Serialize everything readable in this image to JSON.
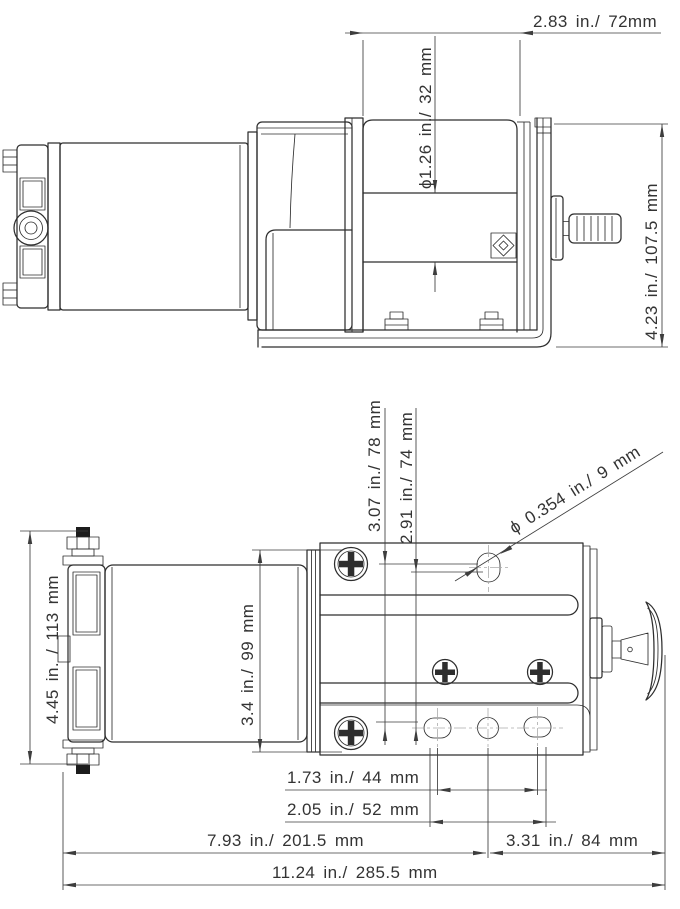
{
  "drawing": {
    "description": "Two-view dimensioned engineering drawing of an electric winch (side view above, top view below)",
    "side_view": {
      "dims": {
        "drum_width": "2.83 in./ 72mm",
        "drum_diameter": "ϕ1.26 in./ 32 mm",
        "overall_height": "4.23 in./ 107.5 mm"
      }
    },
    "top_view": {
      "dims": {
        "hole_offset_a": "3.07 in./ 78 mm",
        "hole_offset_b": "2.91 in./ 74 mm",
        "mount_hole_diameter": "ϕ 0.354 in./ 9 mm",
        "motor_diameter": "4.45 in. / 113 mm",
        "housing_width": "3.4 in./ 99 mm",
        "slot_center_spacing": "1.73 in./ 44 mm",
        "slot_outer_spacing": "2.05 in./ 52 mm",
        "left_to_hole_center": "7.93 in./ 201.5 mm",
        "hole_center_to_right": "3.31 in./ 84 mm",
        "overall_length": "11.24 in./ 285.5 mm"
      }
    },
    "colors": {
      "line": "#2e2e2e",
      "dimension_line": "#3d3d3d",
      "text": "#333333",
      "centerline": "#ababab",
      "background": "#ffffff"
    }
  }
}
